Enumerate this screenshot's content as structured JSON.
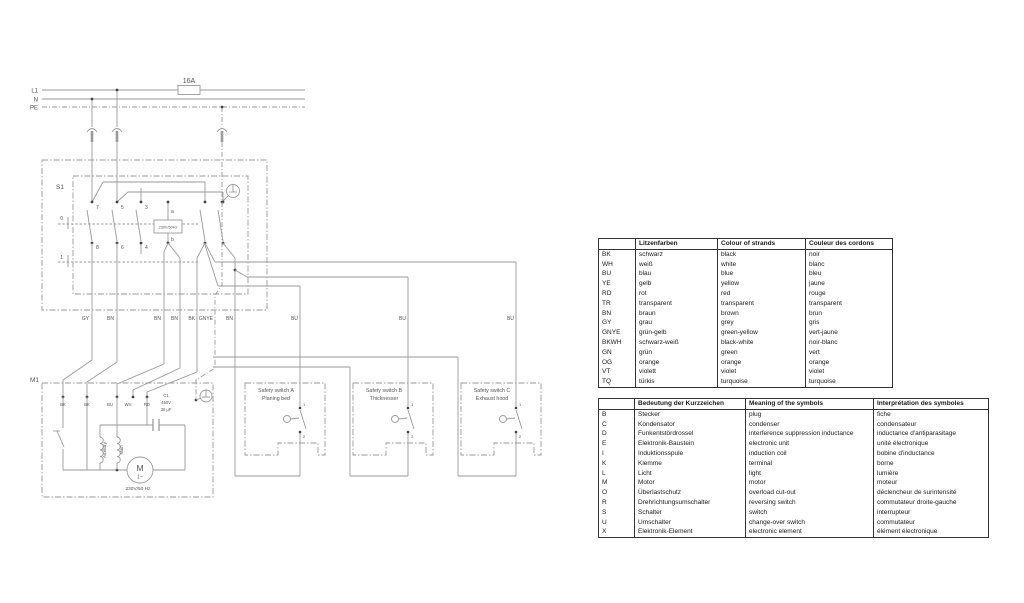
{
  "diagram": {
    "power": {
      "l1": "L1",
      "n": "N",
      "pe": "PE",
      "fuse": "16A"
    },
    "s1": {
      "label": "S1",
      "module": "230V/50Hz",
      "contacts": {
        "c7": "7",
        "c5": "5",
        "c3": "3",
        "c8": "8",
        "c6": "6",
        "c4": "4",
        "a": "a",
        "b": "b"
      },
      "positions": {
        "p0": "0",
        "p1": "1"
      }
    },
    "wires": {
      "gy": "GY",
      "bn_a": "BN",
      "bn_b": "BN",
      "bn_c": "BN",
      "bk": "BK",
      "gnye": "GNYE",
      "bn_d": "BN",
      "bu_a": "BU",
      "bu_b": "BU",
      "bu_c": "BU"
    },
    "m1": {
      "label": "M1",
      "terminals": [
        "BK",
        "BK",
        "BU",
        "WH",
        "RD"
      ],
      "capacitor": {
        "name": "C1",
        "voltage": "450V",
        "capacity": "30 µF"
      },
      "coils": {
        "aux": "Auxiliary",
        "main": "Main"
      },
      "motor": {
        "letter": "M",
        "phase": "1~",
        "rating": "230V/50 Hz"
      }
    },
    "safety_contact": {
      "top": "1",
      "bottom": "2"
    },
    "safety_switches": [
      {
        "title": "Safety switch A",
        "subtitle": "Planing bed"
      },
      {
        "title": "Safety switch B",
        "subtitle": "Thicknesser"
      },
      {
        "title": "Safety switch C",
        "subtitle": "Exhaust hood"
      }
    ]
  },
  "color_table": {
    "headers": [
      "",
      "Litzenfarben",
      "Colour of strands",
      "Couleur des cordons"
    ],
    "rows": [
      [
        "BK",
        "schwarz",
        "black",
        "noir"
      ],
      [
        "WH",
        "weiß",
        "white",
        "blanc"
      ],
      [
        "BU",
        "blau",
        "blue",
        "bleu"
      ],
      [
        "YE",
        "gelb",
        "yellow",
        "jaune"
      ],
      [
        "RD",
        "rot",
        "red",
        "rouge"
      ],
      [
        "TR",
        "transparent",
        "transparent",
        "transparent"
      ],
      [
        "BN",
        "braun",
        "brown",
        "brun"
      ],
      [
        "GY",
        "grau",
        "grey",
        "gris"
      ],
      [
        "GNYE",
        "grün-gelb",
        "green-yellow",
        "vert-jaune"
      ],
      [
        "BKWH",
        "schwarz-weiß",
        "black-white",
        "noir-blanc"
      ],
      [
        "GN",
        "grün",
        "green",
        "vert"
      ],
      [
        "OG",
        "orange",
        "orange",
        "orange"
      ],
      [
        "VT",
        "violett",
        "violet",
        "violet"
      ],
      [
        "TQ",
        "türkis",
        "turquoise",
        "turquoise"
      ]
    ]
  },
  "symbol_table": {
    "headers": [
      "",
      "Bedeutung der Kurzzeichen",
      "Meaning of the symbols",
      "Interprétation des symboles"
    ],
    "rows": [
      [
        "B",
        "Stecker",
        "plug",
        "fiche"
      ],
      [
        "C",
        "Kondensator",
        "condenser",
        "condensateur"
      ],
      [
        "D",
        "Funkentstördrossel",
        "interference suppression inductance",
        "inductance d'antiparasitage"
      ],
      [
        "E",
        "Elektronik-Baustein",
        "electronic unit",
        "unité électronique"
      ],
      [
        "I",
        "Induktionsspule",
        "induction coil",
        "bobine d'inductance"
      ],
      [
        "K",
        "Klemme",
        "terminal",
        "borne"
      ],
      [
        "L",
        "Licht",
        "light",
        "lumière"
      ],
      [
        "M",
        "Motor",
        "motor",
        "moteur"
      ],
      [
        "O",
        "Überlastschutz",
        "overload cut-out",
        "déclencheur de surintensité"
      ],
      [
        "R",
        "Drehrichtungsumschalter",
        "reversing switch",
        "commutateur droite-gauche"
      ],
      [
        "S",
        "Schalter",
        "switch",
        "interrupteur"
      ],
      [
        "U",
        "Umschalter",
        "change-over switch",
        "commutateur"
      ],
      [
        "X",
        "Elektronik-Element",
        "electronic element",
        "élément électronique"
      ]
    ]
  }
}
